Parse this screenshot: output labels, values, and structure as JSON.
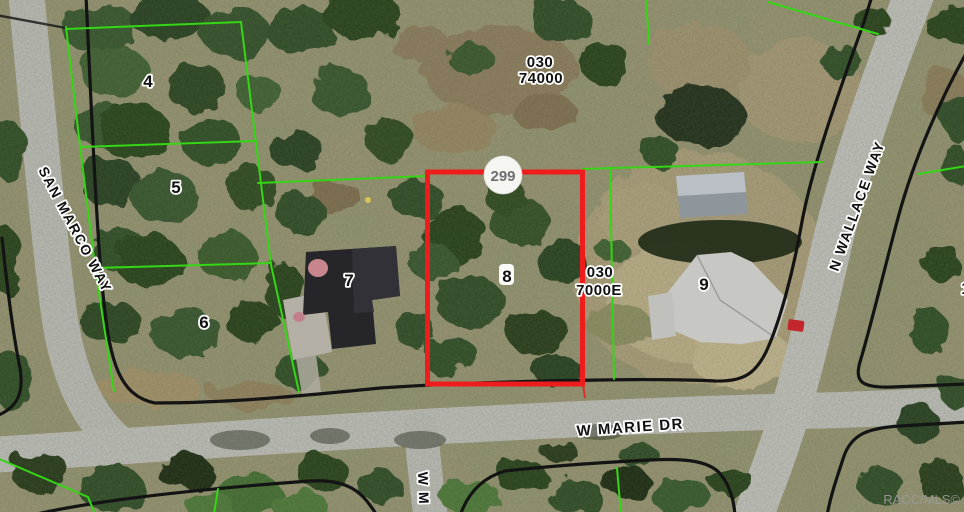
{
  "map": {
    "lot_labels": [
      "4",
      "5",
      "6",
      "7",
      "8",
      "9"
    ],
    "partial_lot_label": "1",
    "street_labels": {
      "san_marco": "SAN MARCO WAY",
      "n_wallace": "N WALLACE WAY",
      "w_marie": "W MARIE DR",
      "south_branch_partial": "W M"
    },
    "parcel_codes": {
      "north": {
        "line1": "030",
        "line2": "74000"
      },
      "east": {
        "line1": "030",
        "line2": "7000E"
      }
    },
    "marker": {
      "label": "299"
    },
    "watermark": "RACC/MLS©",
    "colors": {
      "parcel_line_green": "#35d615",
      "highlight_red": "#ee1c1c",
      "boundary_black": "#141414",
      "road_gray": "#bcbcb8",
      "marker_bg": "#f5f5f2"
    }
  }
}
